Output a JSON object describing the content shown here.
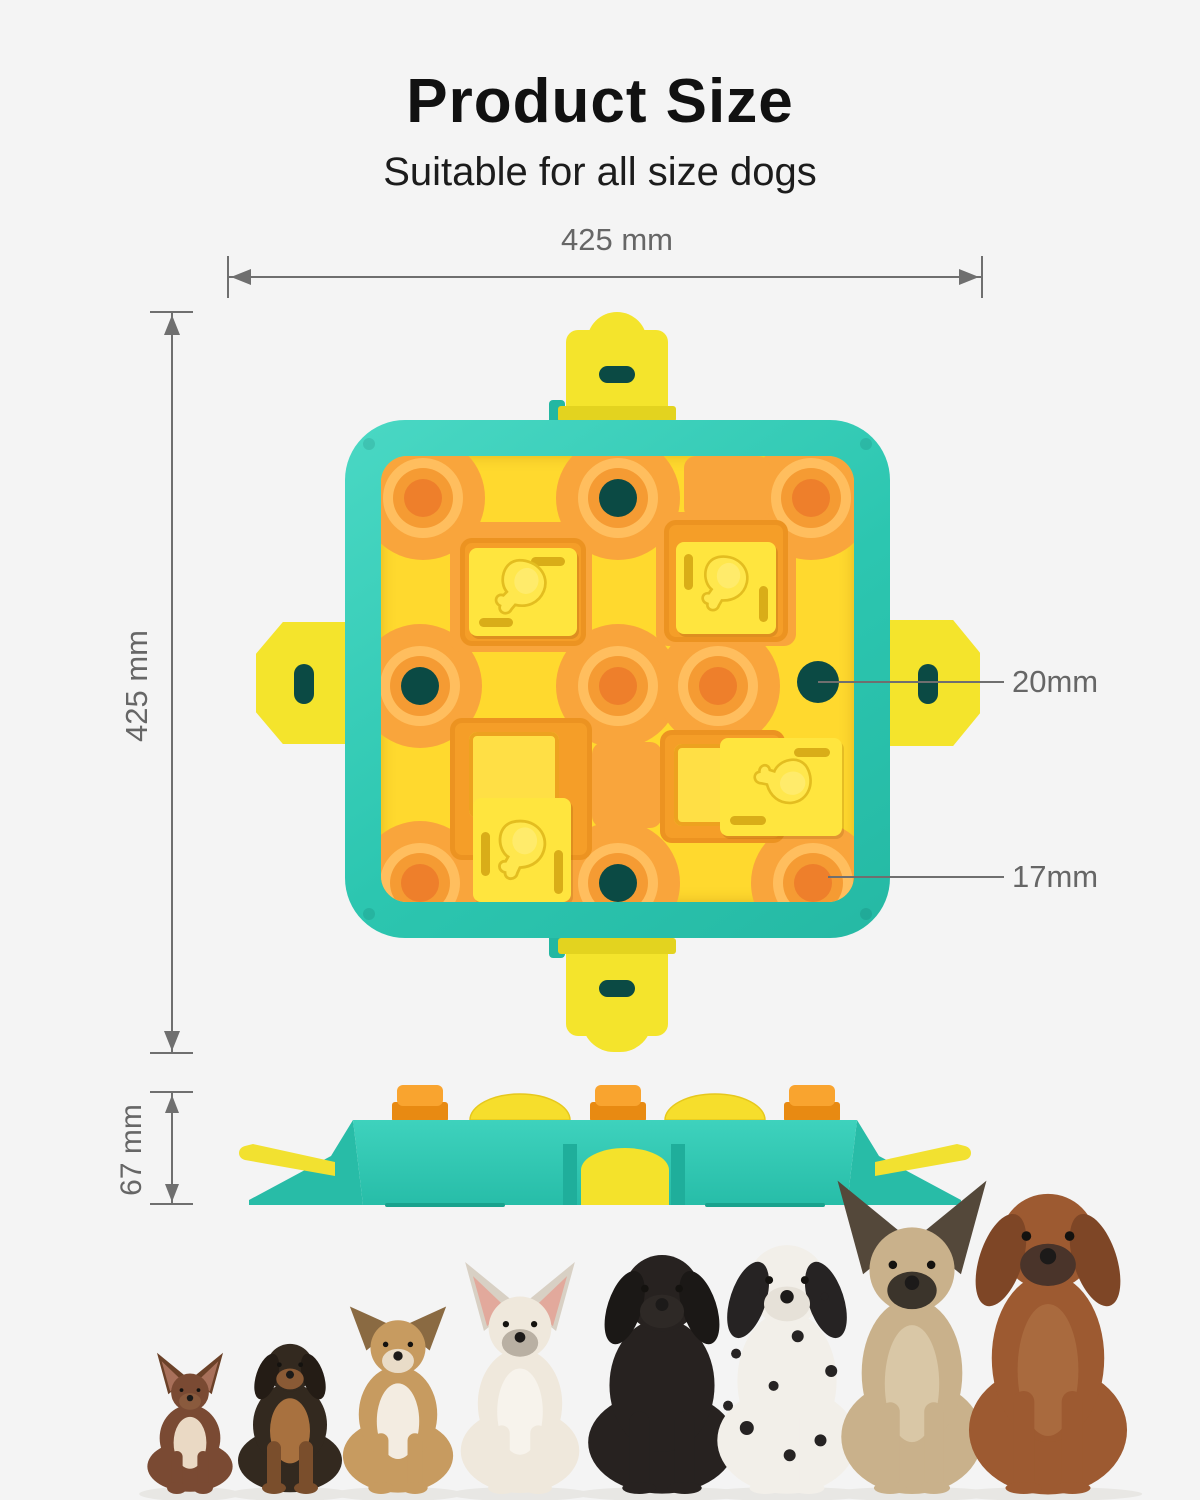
{
  "header": {
    "title": "Product Size",
    "subtitle": "Suitable for all size dogs"
  },
  "dimensions": {
    "width": {
      "label": "425 mm"
    },
    "height": {
      "label": "425 mm"
    },
    "thickness": {
      "label": "67 mm"
    },
    "top_hole": {
      "label": "20mm"
    },
    "treat_well": {
      "label": "17mm"
    }
  },
  "icons": {
    "drumstick": "drumstick-icon"
  },
  "colors": {
    "background": "#f4f4f4",
    "dim_line": "#6f6f6f",
    "dim_text": "#666666",
    "teal": "#2fcbb5",
    "hole_dark": "#0b4a44",
    "panel_yellow": "#ffd92e",
    "clip_yellow": "#f4e42c",
    "slider_yellow": "#ffe53e",
    "orange_pad": "#f9a53c",
    "orange_frame": "#f59e28"
  },
  "dogs": [
    {
      "breed": "chihuahua",
      "cx": 75,
      "h": 118,
      "w": 82,
      "ear": "up",
      "body": "#7a4a33",
      "chest": "#ead9c4",
      "earColor": "#6b4128",
      "earInner": "#a8705a",
      "muzzle": "#8a5a3d"
    },
    {
      "breed": "dachshund",
      "cx": 175,
      "h": 148,
      "w": 100,
      "ear": "floppy",
      "body": "#33291f",
      "chest": "#a8713f",
      "earColor": "#241c15",
      "muzzle": "#8a5a35",
      "leg": "#7a4e2c"
    },
    {
      "breed": "sheltie",
      "cx": 283,
      "h": 172,
      "w": 106,
      "ear": "semi",
      "body": "#c79b60",
      "chest": "#f3ece1",
      "earColor": "#8a6a42",
      "muzzle": "#e9dcc8"
    },
    {
      "breed": "french-bulldog",
      "cx": 405,
      "h": 196,
      "w": 114,
      "ear": "up",
      "body": "#efe8dc",
      "chest": "#f7f3ec",
      "earColor": "#d8d0c4",
      "earInner": "#e2a99c",
      "muzzle": "#b9b0a3"
    },
    {
      "breed": "black-labrador",
      "cx": 547,
      "h": 238,
      "w": 142,
      "ear": "floppy",
      "body": "#272220",
      "earColor": "#1b1816",
      "muzzle": "#2e2926"
    },
    {
      "breed": "dalmatian",
      "cx": 672,
      "h": 248,
      "w": 134,
      "ear": "floppy",
      "body": "#f2efe9",
      "earColor": "#262323",
      "muzzle": "#e6e1d8",
      "spots": "#262323"
    },
    {
      "breed": "malinois",
      "cx": 797,
      "h": 266,
      "w": 136,
      "ear": "up",
      "body": "#c9b18b",
      "chest": "#d9c7a6",
      "earColor": "#54483a",
      "muzzle": "#3b342b"
    },
    {
      "breed": "rhodesian-ridgeback",
      "cx": 933,
      "h": 300,
      "w": 152,
      "ear": "floppy",
      "body": "#9d5a31",
      "chest": "#a96a3e",
      "earColor": "#7e4626",
      "muzzle": "#4a342a"
    }
  ]
}
